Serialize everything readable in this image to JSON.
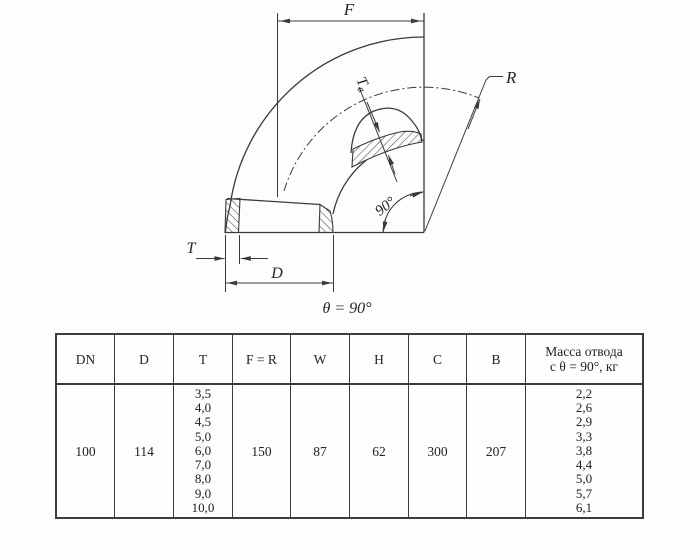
{
  "diagram": {
    "caption": "θ = 90°",
    "labels": {
      "f": "F",
      "r": "R",
      "t": "T",
      "d": "D",
      "t_wall_main": "T",
      "t_wall_sub": "в",
      "angle": "90°"
    }
  },
  "table": {
    "headers": [
      "DN",
      "D",
      "T",
      "F = R",
      "W",
      "H",
      "C",
      "B",
      "Масса отвода\nс θ = 90°, кг"
    ],
    "row": {
      "dn": "100",
      "d": "114",
      "t": [
        "3,5",
        "4,0",
        "4,5",
        "5,0",
        "6,0",
        "7,0",
        "8,0",
        "9,0",
        "10,0"
      ],
      "f_r": "150",
      "w": "87",
      "h": "62",
      "c": "300",
      "b": "207",
      "mass": [
        "2,2",
        "2,6",
        "2,9",
        "3,3",
        "3,8",
        "4,4",
        "5,0",
        "5,7",
        "6,1"
      ]
    }
  },
  "colors": {
    "line": "#3a3a3a",
    "text": "#262626",
    "background": "#fdfdfd"
  }
}
